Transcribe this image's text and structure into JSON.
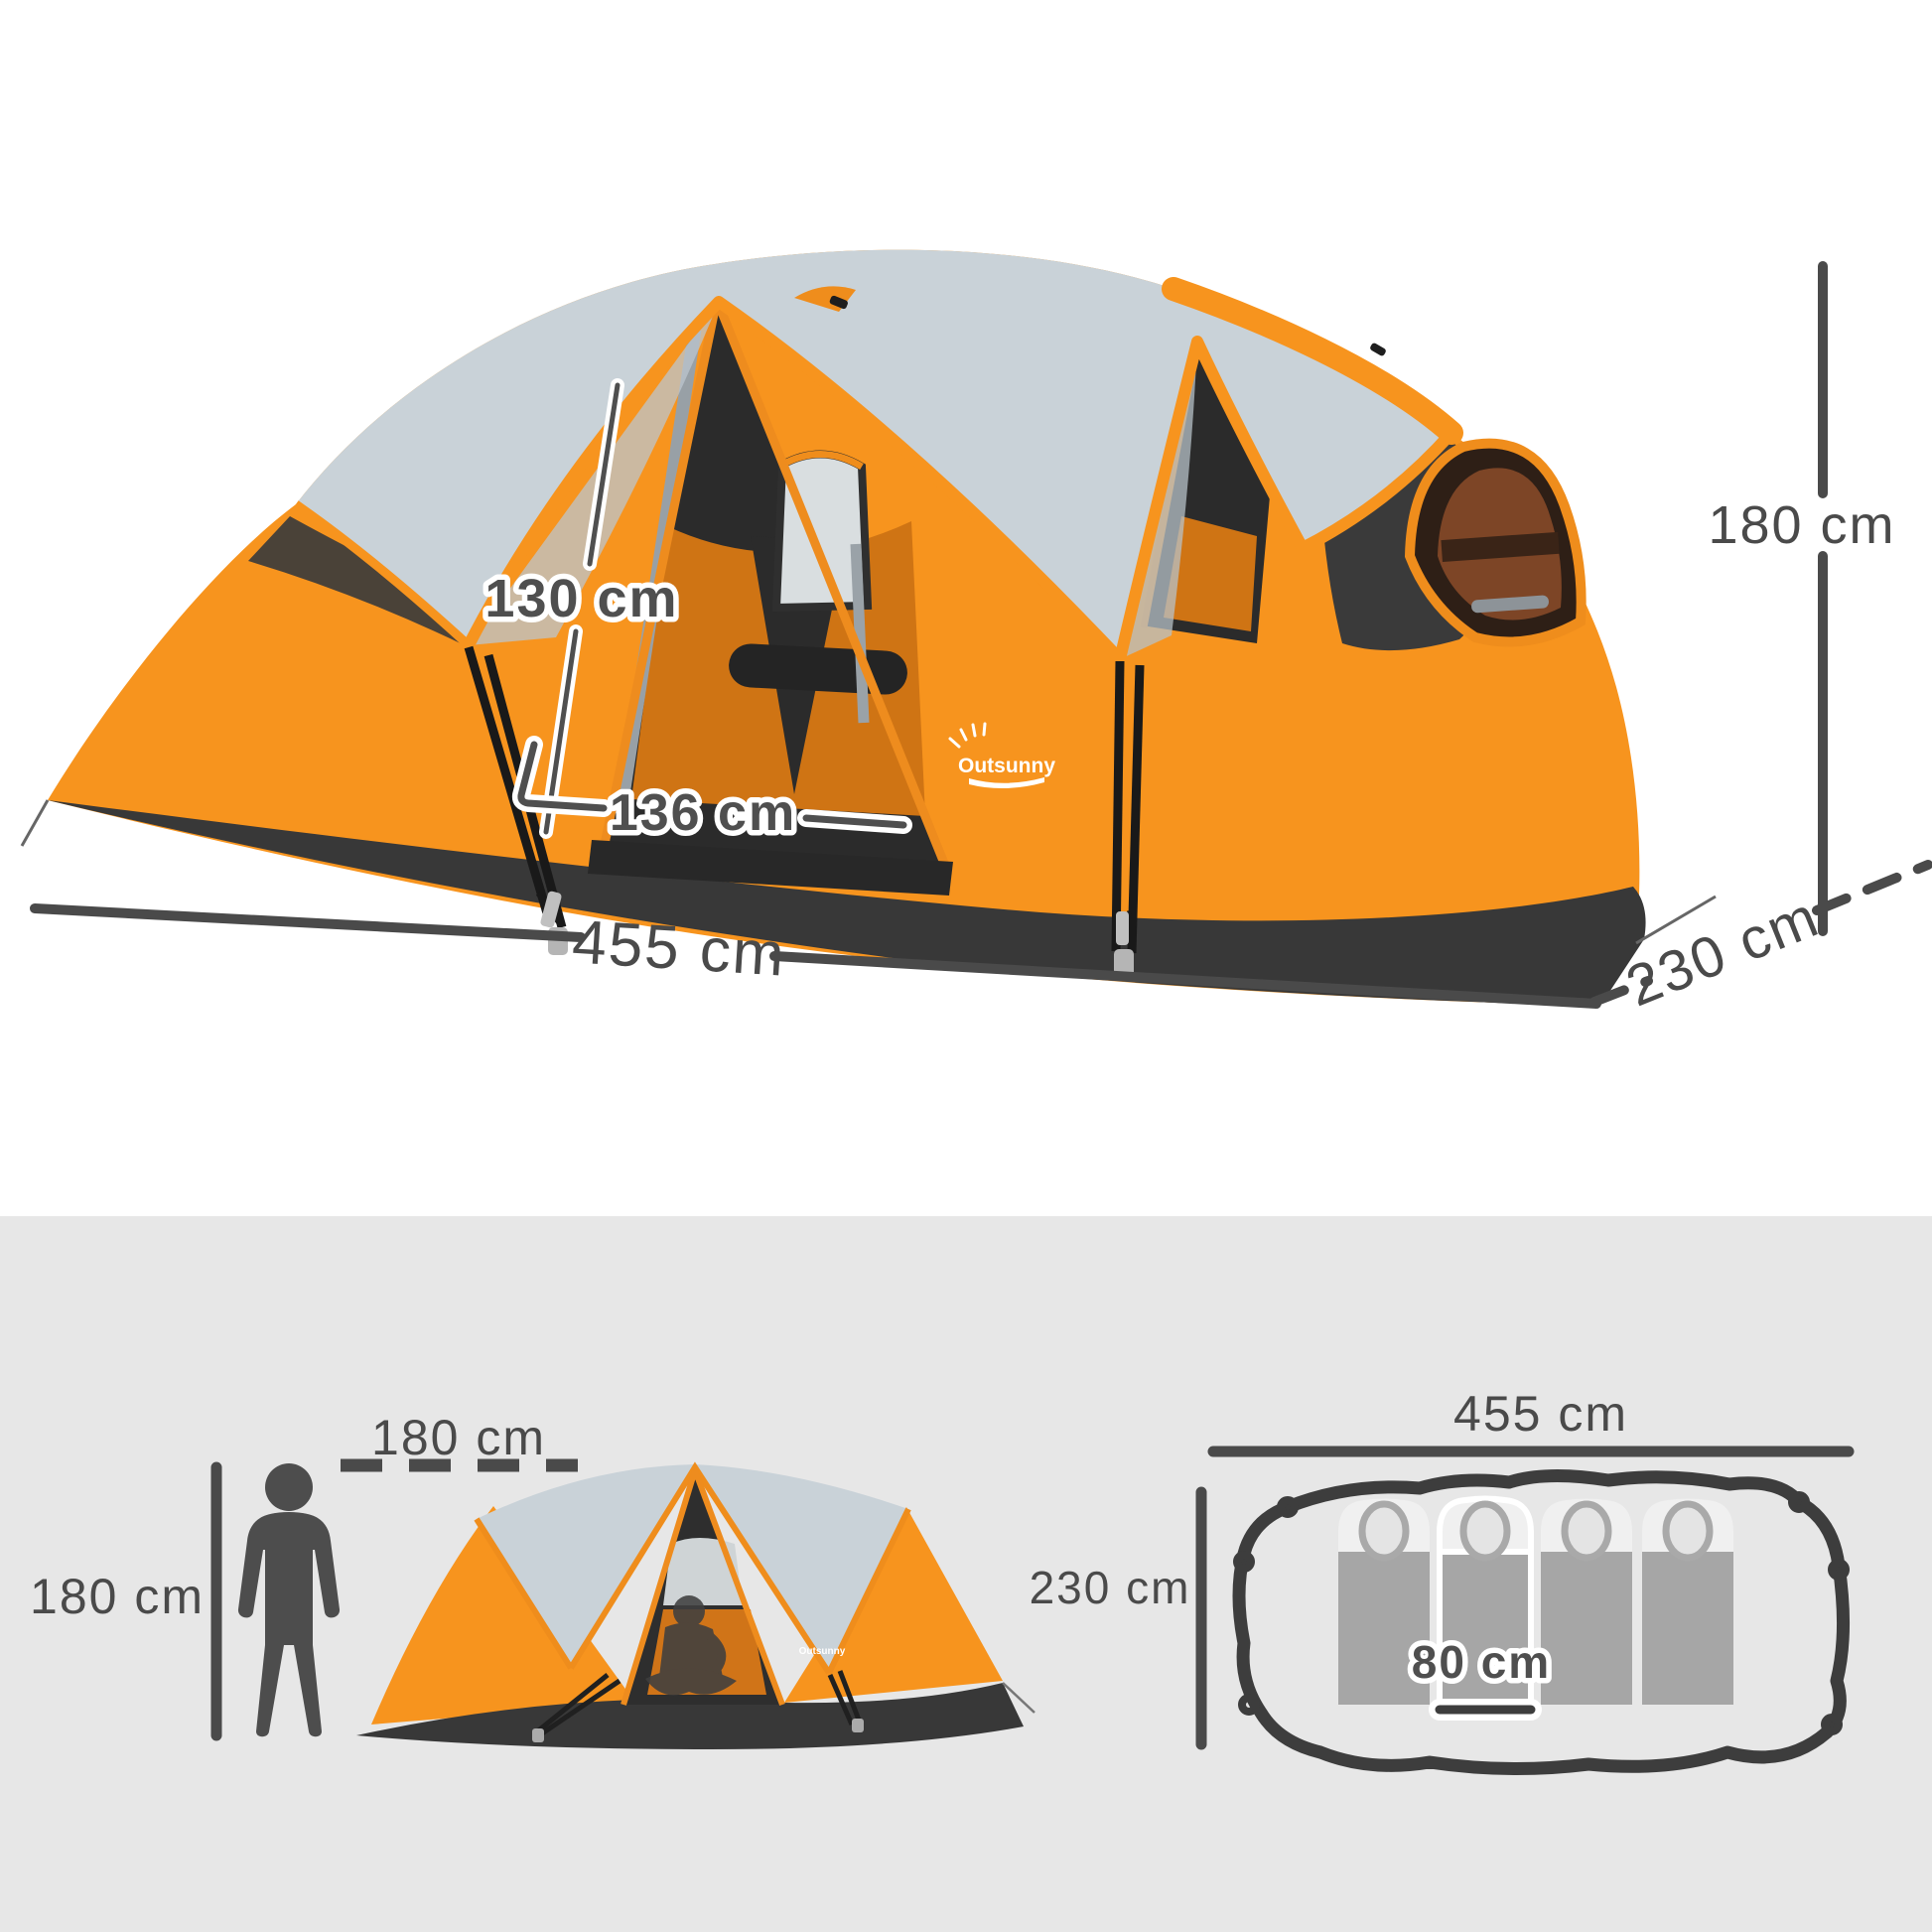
{
  "product": {
    "brand": "Outsunny"
  },
  "colors": {
    "orange": "#F7941E",
    "orange_trim": "#EE8C1E",
    "rainfly_gray": "#C9D2D8",
    "charcoal": "#383838",
    "interior_dark": "#2B2B2B",
    "annotation_gray": "#4A4A4A",
    "band_background": "#E7E7E7",
    "sleeping_bag_gray": "#A6A6A6",
    "white": "#FFFFFF"
  },
  "main_photo": {
    "logo_text": "Outsunny",
    "annotations": {
      "door_height": "130 cm",
      "door_width": "136 cm",
      "length": "455 cm",
      "depth": "230 cm",
      "height": "180 cm"
    }
  },
  "scale_figure": {
    "person_height_label": "180 cm",
    "clearance_label": "180 cm"
  },
  "side_view": {
    "logo_text": "Outsunny"
  },
  "floor_plan": {
    "length_label": "455 cm",
    "depth_label": "230 cm",
    "sleeping_bag_width_label": "80 cm",
    "sleeping_bag_count": 4
  }
}
